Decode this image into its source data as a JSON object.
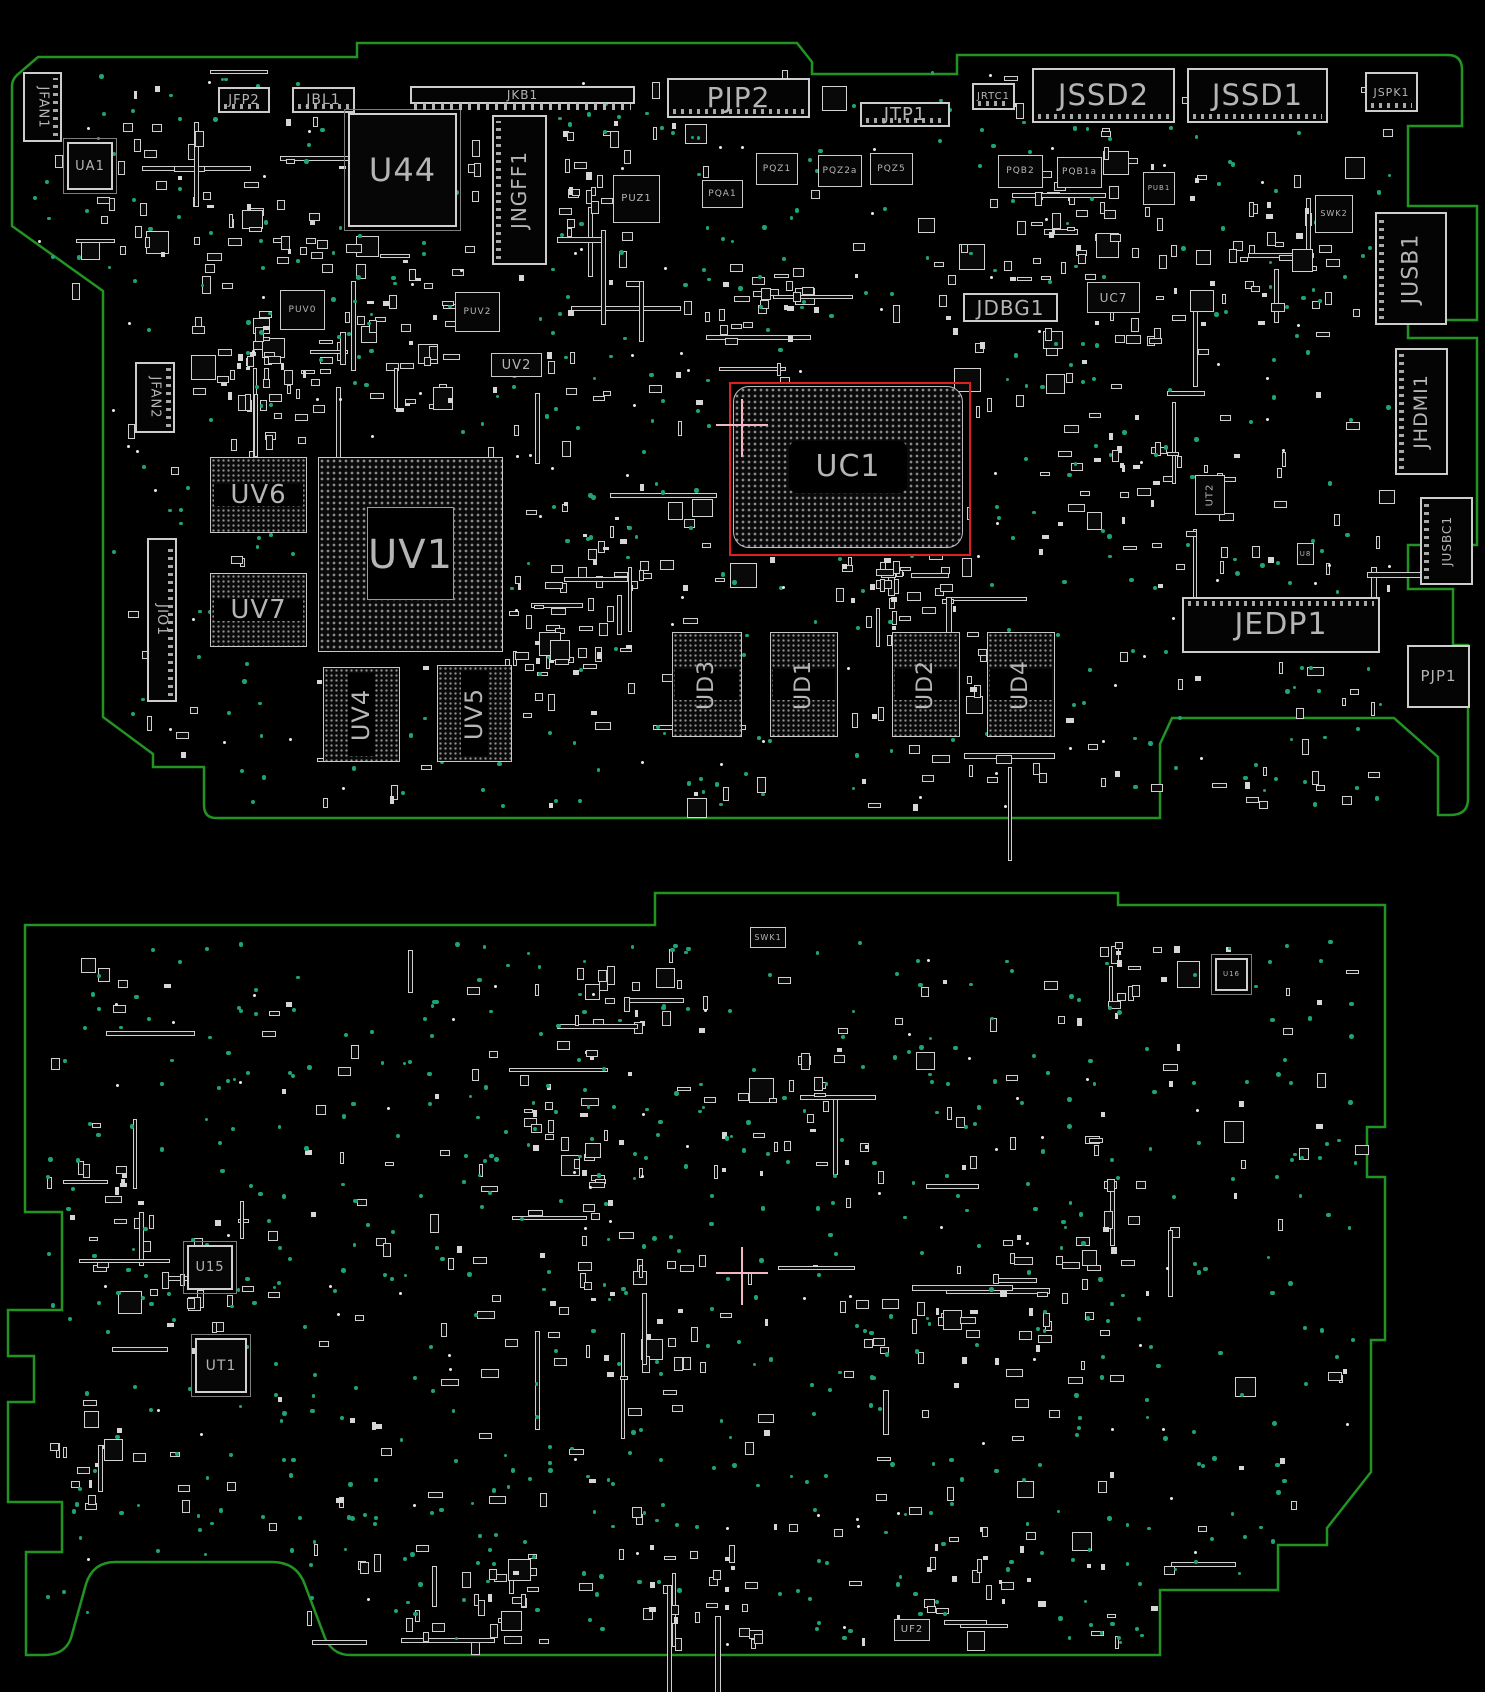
{
  "view": {
    "description_refs_highlighted": "UC1"
  },
  "colors": {
    "background": "#000000",
    "board_outline": "#219421",
    "via": "#1fa37d",
    "component_outline": "#cfcfcf",
    "label": "#b5b5b5",
    "highlight": "#e01f1f",
    "crosshair": "#f0b6c2",
    "bga_dot": "#8f8f8f"
  },
  "highlight": {
    "ref": "UC1",
    "x": 729,
    "y": 382,
    "w": 238,
    "h": 170
  },
  "crosshairs": [
    {
      "x": 742,
      "y": 425
    },
    {
      "x": 742,
      "y": 1273
    }
  ],
  "decoration": {
    "seed": 42,
    "top": {
      "parts": 640,
      "vias": 430,
      "dots": 80
    },
    "bottom": {
      "parts": 500,
      "vias": 540,
      "dots": 60
    }
  },
  "boards": [
    {
      "name": "top",
      "components": [
        {
          "ref": "JFAN1",
          "x": 23,
          "y": 72,
          "w": 39,
          "h": 70,
          "kind": "connector",
          "rot": 90,
          "fs": 13,
          "teeth": "r"
        },
        {
          "ref": "UA1",
          "x": 67,
          "y": 142,
          "w": 46,
          "h": 48,
          "kind": "qfp",
          "rot": 0,
          "fs": 13
        },
        {
          "ref": "JFP2",
          "x": 218,
          "y": 87,
          "w": 52,
          "h": 26,
          "kind": "connector",
          "rot": 0,
          "fs": 13,
          "teeth": "b"
        },
        {
          "ref": "JBL1",
          "x": 292,
          "y": 87,
          "w": 63,
          "h": 26,
          "kind": "connector",
          "rot": 0,
          "fs": 14,
          "teeth": "b"
        },
        {
          "ref": "U44",
          "x": 348,
          "y": 113,
          "w": 109,
          "h": 114,
          "kind": "qfp",
          "rot": 0,
          "fs": 32
        },
        {
          "ref": "JKB1",
          "x": 410,
          "y": 86,
          "w": 225,
          "h": 18,
          "kind": "connector",
          "rot": 0,
          "fs": 12,
          "teeth": "comb"
        },
        {
          "ref": "JNGFF1",
          "x": 492,
          "y": 115,
          "w": 55,
          "h": 150,
          "kind": "connector",
          "rot": -90,
          "fs": 20,
          "teeth": "l"
        },
        {
          "ref": "PJP2",
          "x": 667,
          "y": 78,
          "w": 143,
          "h": 40,
          "kind": "connector",
          "rot": 0,
          "fs": 28,
          "teeth": "b"
        },
        {
          "ref": "JTP1",
          "x": 860,
          "y": 102,
          "w": 90,
          "h": 25,
          "kind": "connector",
          "rot": 0,
          "fs": 18,
          "teeth": "b"
        },
        {
          "ref": "JRTC1",
          "x": 972,
          "y": 83,
          "w": 43,
          "h": 27,
          "kind": "connector",
          "rot": 0,
          "fs": 10,
          "teeth": "b"
        },
        {
          "ref": "JSSD2",
          "x": 1032,
          "y": 68,
          "w": 143,
          "h": 55,
          "kind": "connector",
          "rot": 0,
          "fs": 29,
          "teeth": "b"
        },
        {
          "ref": "JSSD1",
          "x": 1187,
          "y": 68,
          "w": 141,
          "h": 55,
          "kind": "connector",
          "rot": 0,
          "fs": 29,
          "teeth": "b"
        },
        {
          "ref": "JSPK1",
          "x": 1365,
          "y": 72,
          "w": 53,
          "h": 40,
          "kind": "connector",
          "rot": 0,
          "fs": 11,
          "teeth": "b"
        },
        {
          "ref": "PUZ1",
          "x": 613,
          "y": 175,
          "w": 47,
          "h": 48,
          "kind": "qfn",
          "rot": 0,
          "fs": 10
        },
        {
          "ref": "PQA1",
          "x": 702,
          "y": 180,
          "w": 41,
          "h": 28,
          "kind": "qfn",
          "rot": 0,
          "fs": 9
        },
        {
          "ref": "PQZ1",
          "x": 756,
          "y": 153,
          "w": 42,
          "h": 32,
          "kind": "qfn",
          "rot": 0,
          "fs": 9
        },
        {
          "ref": "PQZ2a",
          "x": 818,
          "y": 155,
          "w": 44,
          "h": 32,
          "kind": "qfn",
          "rot": 0,
          "fs": 9
        },
        {
          "ref": "PQZ5",
          "x": 870,
          "y": 153,
          "w": 43,
          "h": 32,
          "kind": "qfn",
          "rot": 0,
          "fs": 9
        },
        {
          "ref": "PQB2",
          "x": 998,
          "y": 155,
          "w": 45,
          "h": 33,
          "kind": "qfn",
          "rot": 0,
          "fs": 9
        },
        {
          "ref": "PQB1a",
          "x": 1057,
          "y": 157,
          "w": 45,
          "h": 31,
          "kind": "qfn",
          "rot": 0,
          "fs": 9
        },
        {
          "ref": "PUB1",
          "x": 1143,
          "y": 172,
          "w": 32,
          "h": 33,
          "kind": "qfn",
          "rot": 0,
          "fs": 7
        },
        {
          "ref": "SWK2",
          "x": 1315,
          "y": 195,
          "w": 38,
          "h": 38,
          "kind": "qfn",
          "rot": 0,
          "fs": 8
        },
        {
          "ref": "JDBG1",
          "x": 963,
          "y": 293,
          "w": 95,
          "h": 29,
          "kind": "connector",
          "rot": 0,
          "fs": 20
        },
        {
          "ref": "UC7",
          "x": 1087,
          "y": 282,
          "w": 53,
          "h": 31,
          "kind": "chip",
          "rot": 0,
          "fs": 12
        },
        {
          "ref": "PUV0",
          "x": 280,
          "y": 290,
          "w": 45,
          "h": 40,
          "kind": "qfn",
          "rot": 0,
          "fs": 9
        },
        {
          "ref": "PUV2",
          "x": 455,
          "y": 292,
          "w": 45,
          "h": 40,
          "kind": "qfn",
          "rot": 0,
          "fs": 9
        },
        {
          "ref": "UV2",
          "x": 491,
          "y": 353,
          "w": 51,
          "h": 24,
          "kind": "chip",
          "rot": 0,
          "fs": 13
        },
        {
          "ref": "JFAN2",
          "x": 135,
          "y": 362,
          "w": 40,
          "h": 71,
          "kind": "connector",
          "rot": 90,
          "fs": 13,
          "teeth": "r"
        },
        {
          "ref": "JIO1",
          "x": 147,
          "y": 538,
          "w": 30,
          "h": 164,
          "kind": "connector",
          "rot": 90,
          "fs": 14,
          "teeth": "r"
        },
        {
          "ref": "UV6",
          "x": 210,
          "y": 457,
          "w": 97,
          "h": 76,
          "kind": "bga",
          "rot": 0,
          "fs": 26,
          "band": "h"
        },
        {
          "ref": "UV7",
          "x": 210,
          "y": 573,
          "w": 97,
          "h": 74,
          "kind": "bga",
          "rot": 0,
          "fs": 26,
          "band": "h"
        },
        {
          "ref": "UV1",
          "x": 318,
          "y": 457,
          "w": 185,
          "h": 195,
          "kind": "bga-big",
          "rot": 0,
          "fs": 40,
          "band": "sq"
        },
        {
          "ref": "UC1",
          "x": 733,
          "y": 386,
          "w": 230,
          "h": 162,
          "kind": "bga-big",
          "rot": 0,
          "fs": 30,
          "band": "pill",
          "round": true
        },
        {
          "ref": "UV4",
          "x": 323,
          "y": 667,
          "w": 77,
          "h": 95,
          "kind": "bga",
          "rot": -90,
          "fs": 24,
          "band": "v"
        },
        {
          "ref": "UV5",
          "x": 437,
          "y": 665,
          "w": 75,
          "h": 97,
          "kind": "bga",
          "rot": -90,
          "fs": 24,
          "band": "v"
        },
        {
          "ref": "UD3",
          "x": 672,
          "y": 632,
          "w": 70,
          "h": 105,
          "kind": "bga",
          "rot": -90,
          "fs": 22,
          "band": "h"
        },
        {
          "ref": "UD1",
          "x": 770,
          "y": 632,
          "w": 68,
          "h": 105,
          "kind": "bga",
          "rot": -90,
          "fs": 22,
          "band": "h"
        },
        {
          "ref": "UD2",
          "x": 892,
          "y": 632,
          "w": 68,
          "h": 105,
          "kind": "bga",
          "rot": -90,
          "fs": 22,
          "band": "h"
        },
        {
          "ref": "UD4",
          "x": 987,
          "y": 632,
          "w": 68,
          "h": 105,
          "kind": "bga",
          "rot": -90,
          "fs": 22,
          "band": "h"
        },
        {
          "ref": "UT2",
          "x": 1195,
          "y": 475,
          "w": 30,
          "h": 40,
          "kind": "qfn",
          "rot": -90,
          "fs": 10
        },
        {
          "ref": "U8",
          "x": 1297,
          "y": 543,
          "w": 17,
          "h": 22,
          "kind": "qfn",
          "rot": 0,
          "fs": 7
        },
        {
          "ref": "JEDP1",
          "x": 1182,
          "y": 597,
          "w": 198,
          "h": 56,
          "kind": "connector",
          "rot": 0,
          "fs": 30,
          "teeth": "t"
        },
        {
          "ref": "PJP1",
          "x": 1407,
          "y": 645,
          "w": 63,
          "h": 63,
          "kind": "connector",
          "rot": 0,
          "fs": 15
        },
        {
          "ref": "JUSB1",
          "x": 1375,
          "y": 212,
          "w": 72,
          "h": 113,
          "kind": "connector",
          "rot": -90,
          "fs": 22,
          "teeth": "l"
        },
        {
          "ref": "JHDMI1",
          "x": 1395,
          "y": 348,
          "w": 53,
          "h": 127,
          "kind": "connector",
          "rot": -90,
          "fs": 19,
          "teeth": "l"
        },
        {
          "ref": "JUSBC1",
          "x": 1420,
          "y": 497,
          "w": 53,
          "h": 88,
          "kind": "connector",
          "rot": -90,
          "fs": 12,
          "teeth": "l"
        }
      ]
    },
    {
      "name": "bottom",
      "components": [
        {
          "ref": "SWK1",
          "x": 750,
          "y": 927,
          "w": 36,
          "h": 21,
          "kind": "qfn",
          "rot": 0,
          "fs": 8
        },
        {
          "ref": "U16",
          "x": 1215,
          "y": 958,
          "w": 33,
          "h": 33,
          "kind": "qfp",
          "rot": 0,
          "fs": 7
        },
        {
          "ref": "U15",
          "x": 187,
          "y": 1245,
          "w": 46,
          "h": 45,
          "kind": "qfp",
          "rot": 0,
          "fs": 13
        },
        {
          "ref": "UT1",
          "x": 195,
          "y": 1338,
          "w": 52,
          "h": 55,
          "kind": "qfp",
          "rot": 0,
          "fs": 14
        },
        {
          "ref": "UF2",
          "x": 894,
          "y": 1619,
          "w": 36,
          "h": 22,
          "kind": "chip",
          "rot": 0,
          "fs": 10
        }
      ]
    }
  ]
}
